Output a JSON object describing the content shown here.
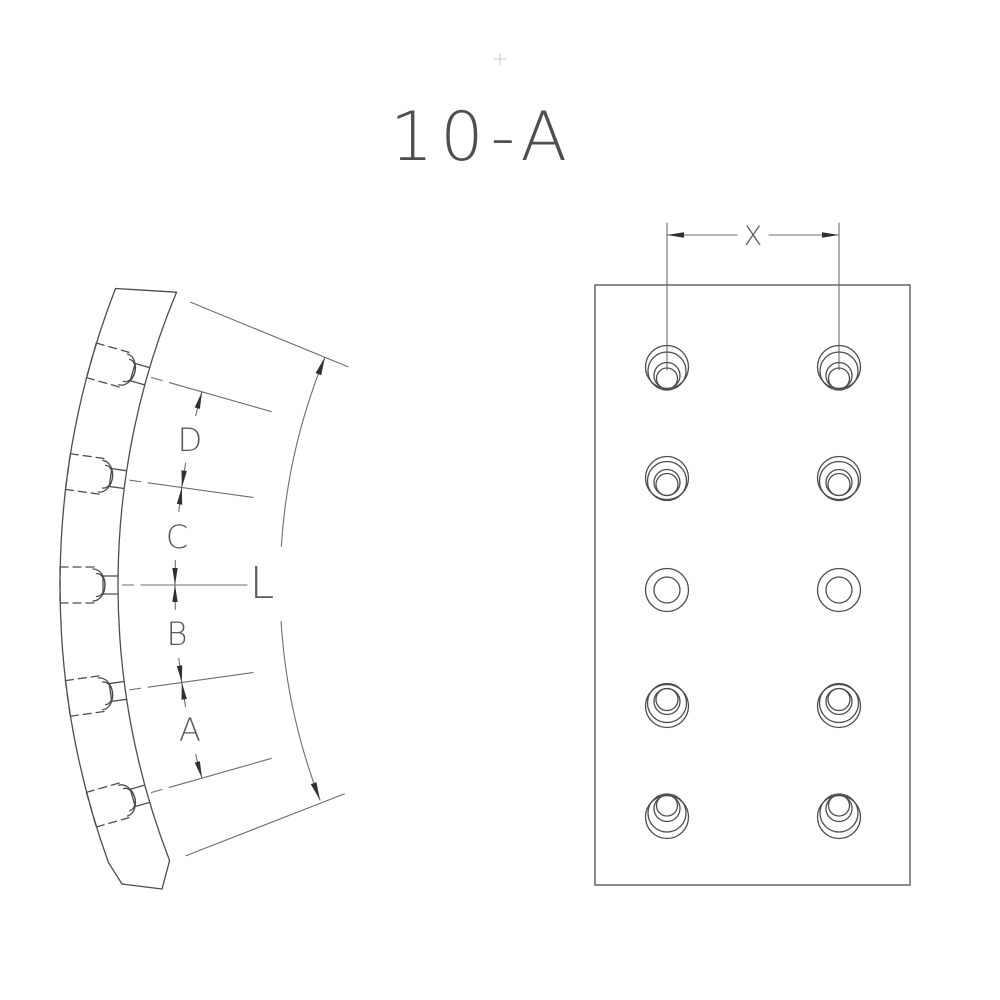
{
  "title": "10-A",
  "colors": {
    "background": "#ffffff",
    "line": "#4d4d4d",
    "thin_line": "#6e6e6e",
    "arrow": "#303030",
    "text": "#5a5a5a"
  },
  "left_view": {
    "description": "curved lining segment side profile with countersunk rivet holes",
    "chain_labels": [
      "D",
      "C",
      "B",
      "A"
    ],
    "arc_label": "L",
    "rivet_hole_count": 5
  },
  "right_view": {
    "description": "lining face view with rivet hole pattern",
    "spacing_label": "X",
    "hole_columns": 2,
    "hole_rows": 5
  }
}
